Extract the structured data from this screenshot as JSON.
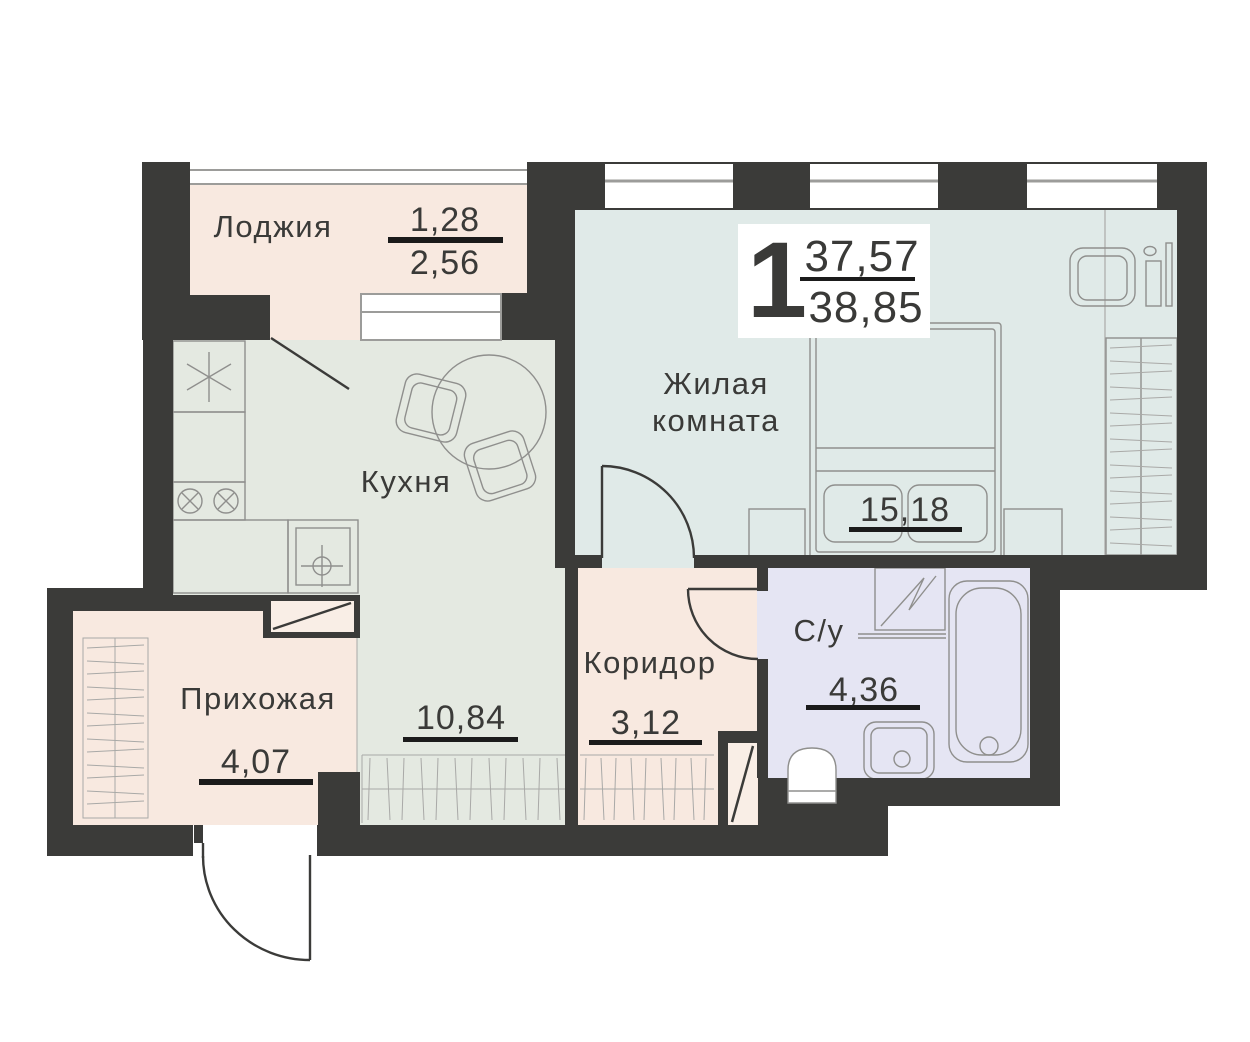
{
  "badge": {
    "room_count": "1",
    "area_living": "37,57",
    "area_total": "38,85"
  },
  "rooms": {
    "loggia": {
      "label": "Лоджия",
      "area_reduced": "1,28",
      "area_full": "2,56",
      "color": "#f8e9e0"
    },
    "kitchen": {
      "label": "Кухня",
      "area": "10,84",
      "color": "#e4e9e1"
    },
    "living_room": {
      "label_line1": "Жилая",
      "label_line2": "комната",
      "area": "15,18",
      "color": "#e0eae8"
    },
    "corridor": {
      "label": "Коридор",
      "area": "3,12",
      "color": "#f8e9e0"
    },
    "hallway": {
      "label": "Прихожая",
      "area": "4,07",
      "color": "#f8e9e0"
    },
    "bathroom": {
      "label": "С/у",
      "area": "4,36",
      "color": "#e5e5f3"
    }
  },
  "colors": {
    "wall": "#3b3b39",
    "text": "#3a3a38",
    "underline": "#1b1b1b",
    "badge_bg": "#ffffff",
    "furniture_outline": "#8f8f8d",
    "window_line": "#9c9c9a",
    "cabinet_fill": "#f9eee6"
  }
}
